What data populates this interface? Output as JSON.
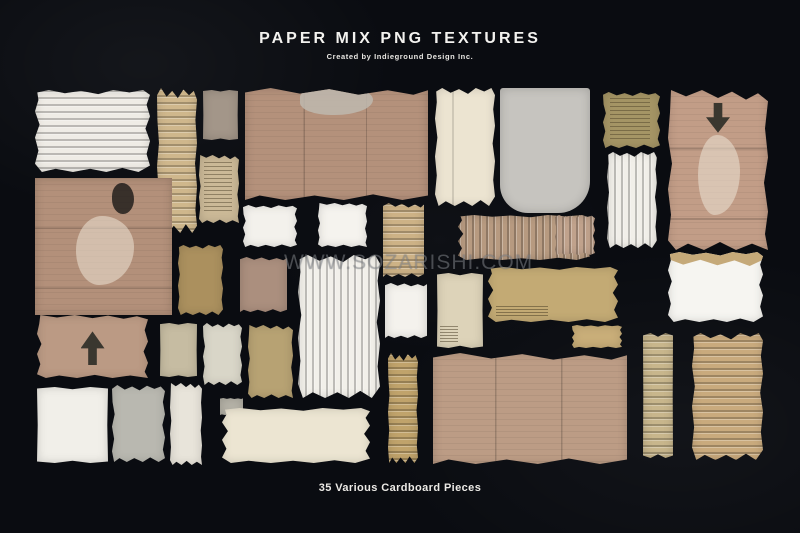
{
  "background_color": "#0a0c11",
  "header": {
    "title": "PAPER MIX PNG TEXTURES",
    "subtitle": "Created by Indieground Design Inc.",
    "title_color": "#f3f2ef"
  },
  "watermark": {
    "text": "WWW.SOZARISHI.COM",
    "color": "rgba(165,170,176,0.42)"
  },
  "footer": {
    "caption": "35 Various Cardboard Pieces"
  },
  "collage": {
    "piece_count_stated": 35,
    "pieces": [
      {
        "id": "white-corrugated-top-left",
        "x": 35,
        "y": 90,
        "w": 115,
        "h": 82,
        "color": "#efece6",
        "kind": "ribs-h",
        "torn": "a",
        "marks": []
      },
      {
        "id": "gold-corrugated-tall-strip",
        "x": 157,
        "y": 88,
        "w": 40,
        "h": 145,
        "color": "#cfb78c",
        "kind": "ribs-h",
        "torn": "b",
        "marks": []
      },
      {
        "id": "taupe-small-rectangle",
        "x": 203,
        "y": 90,
        "w": 35,
        "h": 50,
        "color": "#a39689",
        "kind": "flat",
        "torn": "e",
        "marks": []
      },
      {
        "id": "tan-printed-scrap",
        "x": 199,
        "y": 155,
        "w": 40,
        "h": 68,
        "color": "#cbb997",
        "kind": "flat",
        "torn": "c",
        "marks": [
          "print"
        ]
      },
      {
        "id": "kraft-panel-top-center",
        "x": 245,
        "y": 88,
        "w": 183,
        "h": 112,
        "color": "#b4917b",
        "kind": "panel-v",
        "torn": "d",
        "marks": [
          "patch-top"
        ]
      },
      {
        "id": "cream-tall-folded-piece",
        "x": 435,
        "y": 88,
        "w": 60,
        "h": 118,
        "color": "#ece4d1",
        "kind": "flat",
        "torn": "a",
        "marks": [
          "crease-v"
        ]
      },
      {
        "id": "gray-smooth-rounded-piece",
        "x": 500,
        "y": 88,
        "w": 90,
        "h": 125,
        "color": "#c6c4bf",
        "kind": "flat",
        "torn": "",
        "extra": "round-b",
        "marks": []
      },
      {
        "id": "olive-printed-scrap",
        "x": 603,
        "y": 92,
        "w": 57,
        "h": 56,
        "color": "#a59565",
        "kind": "flat",
        "torn": "b",
        "marks": [
          "print"
        ]
      },
      {
        "id": "pink-panel-arrow-down",
        "x": 668,
        "y": 90,
        "w": 100,
        "h": 160,
        "color": "#c29d87",
        "kind": "panel-h",
        "torn": "c",
        "marks": [
          "arrow-down",
          "patch"
        ]
      },
      {
        "id": "white-corrugated-right",
        "x": 607,
        "y": 152,
        "w": 50,
        "h": 96,
        "color": "#f1efe9",
        "kind": "ribs-v",
        "torn": "a",
        "marks": []
      },
      {
        "id": "white-scrap-1",
        "x": 243,
        "y": 205,
        "w": 54,
        "h": 42,
        "color": "#f3f1ec",
        "kind": "flat",
        "torn": "b",
        "marks": []
      },
      {
        "id": "white-scrap-2",
        "x": 318,
        "y": 203,
        "w": 49,
        "h": 44,
        "color": "#f5f3ee",
        "kind": "flat",
        "torn": "c",
        "marks": []
      },
      {
        "id": "gold-corrugated-mid-strip",
        "x": 383,
        "y": 203,
        "w": 41,
        "h": 74,
        "color": "#cdb286",
        "kind": "ribs-h",
        "torn": "d",
        "marks": []
      },
      {
        "id": "brown-corrugated-wide",
        "x": 458,
        "y": 215,
        "w": 132,
        "h": 45,
        "color": "#b79a80",
        "kind": "ribs-v",
        "torn": "a",
        "marks": []
      },
      {
        "id": "pink-corrugated-small",
        "x": 555,
        "y": 215,
        "w": 40,
        "h": 40,
        "color": "#c0a28c",
        "kind": "ribs-v",
        "torn": "b",
        "marks": []
      },
      {
        "id": "kraft-panel-left-patched",
        "x": 35,
        "y": 178,
        "w": 137,
        "h": 137,
        "color": "#b3907a",
        "kind": "panel-h",
        "torn": "",
        "marks": [
          "patch",
          "smudge"
        ]
      },
      {
        "id": "kraft-panel-arrow-up",
        "x": 37,
        "y": 315,
        "w": 111,
        "h": 63,
        "color": "#bb9a84",
        "kind": "flat",
        "torn": "c",
        "marks": [
          "arrow-up"
        ]
      },
      {
        "id": "dark-gold-torn-piece",
        "x": 178,
        "y": 245,
        "w": 45,
        "h": 70,
        "color": "#ab905e",
        "kind": "flat",
        "torn": "a",
        "marks": []
      },
      {
        "id": "khaki-flat-rectangle",
        "x": 160,
        "y": 323,
        "w": 37,
        "h": 54,
        "color": "#c6bca2",
        "kind": "flat",
        "torn": "e",
        "marks": []
      },
      {
        "id": "pale-tall-torn-piece",
        "x": 203,
        "y": 323,
        "w": 39,
        "h": 62,
        "color": "#d9d6c8",
        "kind": "flat",
        "torn": "b",
        "marks": []
      },
      {
        "id": "mauve-torn-rectangle",
        "x": 240,
        "y": 257,
        "w": 47,
        "h": 55,
        "color": "#ab8f7e",
        "kind": "flat",
        "torn": "d",
        "marks": []
      },
      {
        "id": "white-ribbed-tall-center",
        "x": 298,
        "y": 255,
        "w": 82,
        "h": 143,
        "color": "#f2f0ea",
        "kind": "ribs-v",
        "torn": "a",
        "marks": []
      },
      {
        "id": "gold-torn-mid-piece",
        "x": 248,
        "y": 325,
        "w": 45,
        "h": 73,
        "color": "#b7a273",
        "kind": "flat",
        "torn": "c",
        "marks": []
      },
      {
        "id": "white-scrap-3",
        "x": 385,
        "y": 283,
        "w": 42,
        "h": 55,
        "color": "#f4f2ed",
        "kind": "flat",
        "torn": "d",
        "marks": []
      },
      {
        "id": "cream-flat-printed",
        "x": 437,
        "y": 273,
        "w": 46,
        "h": 75,
        "color": "#ddd3b9",
        "kind": "flat",
        "torn": "e",
        "marks": [
          "print-sm"
        ]
      },
      {
        "id": "gold-wide-torn-piece",
        "x": 488,
        "y": 267,
        "w": 130,
        "h": 55,
        "color": "#c3aa74",
        "kind": "flat",
        "torn": "a",
        "marks": [
          "print-sm"
        ]
      },
      {
        "id": "gold-small-strip",
        "x": 572,
        "y": 325,
        "w": 50,
        "h": 23,
        "color": "#c9ae79",
        "kind": "flat",
        "torn": "b",
        "marks": []
      },
      {
        "id": "white-over-tan-piece",
        "x": 668,
        "y": 252,
        "w": 95,
        "h": 70,
        "color": "#f6f5f1",
        "kind": "flat",
        "torn": "a",
        "marks": [
          "band-top"
        ]
      },
      {
        "id": "gold-diagonal-strip",
        "x": 388,
        "y": 353,
        "w": 30,
        "h": 110,
        "color": "#c0a36b",
        "kind": "ribs-h",
        "torn": "b",
        "marks": []
      },
      {
        "id": "big-panel-bottom-right",
        "x": 433,
        "y": 353,
        "w": 194,
        "h": 111,
        "color": "#bc9c85",
        "kind": "panel-v",
        "torn": "d",
        "marks": []
      },
      {
        "id": "khaki-narrow-ribbed-strip",
        "x": 643,
        "y": 333,
        "w": 30,
        "h": 125,
        "color": "#c8b68c",
        "kind": "ribs-h",
        "torn": "e",
        "marks": []
      },
      {
        "id": "tan-corrugated-bottom-right",
        "x": 692,
        "y": 333,
        "w": 71,
        "h": 127,
        "color": "#c9aa7d",
        "kind": "ribs-h",
        "torn": "a",
        "marks": []
      },
      {
        "id": "white-square-bottom-left",
        "x": 37,
        "y": 387,
        "w": 71,
        "h": 76,
        "color": "#f1efe9",
        "kind": "flat",
        "torn": "e",
        "marks": []
      },
      {
        "id": "gray-torn-bottom-piece",
        "x": 112,
        "y": 385,
        "w": 53,
        "h": 77,
        "color": "#b9b8b0",
        "kind": "flat",
        "torn": "b",
        "marks": []
      },
      {
        "id": "white-tan-tall-scrap",
        "x": 170,
        "y": 383,
        "w": 32,
        "h": 82,
        "color": "#e8e4da",
        "kind": "flat",
        "torn": "c",
        "marks": []
      },
      {
        "id": "gray-small-scrap",
        "x": 220,
        "y": 398,
        "w": 23,
        "h": 17,
        "color": "#b6b3a8",
        "kind": "flat",
        "torn": "d",
        "marks": []
      },
      {
        "id": "ivory-wide-bottom-piece",
        "x": 222,
        "y": 408,
        "w": 148,
        "h": 55,
        "color": "#ece5d2",
        "kind": "flat",
        "torn": "a",
        "marks": []
      }
    ]
  }
}
